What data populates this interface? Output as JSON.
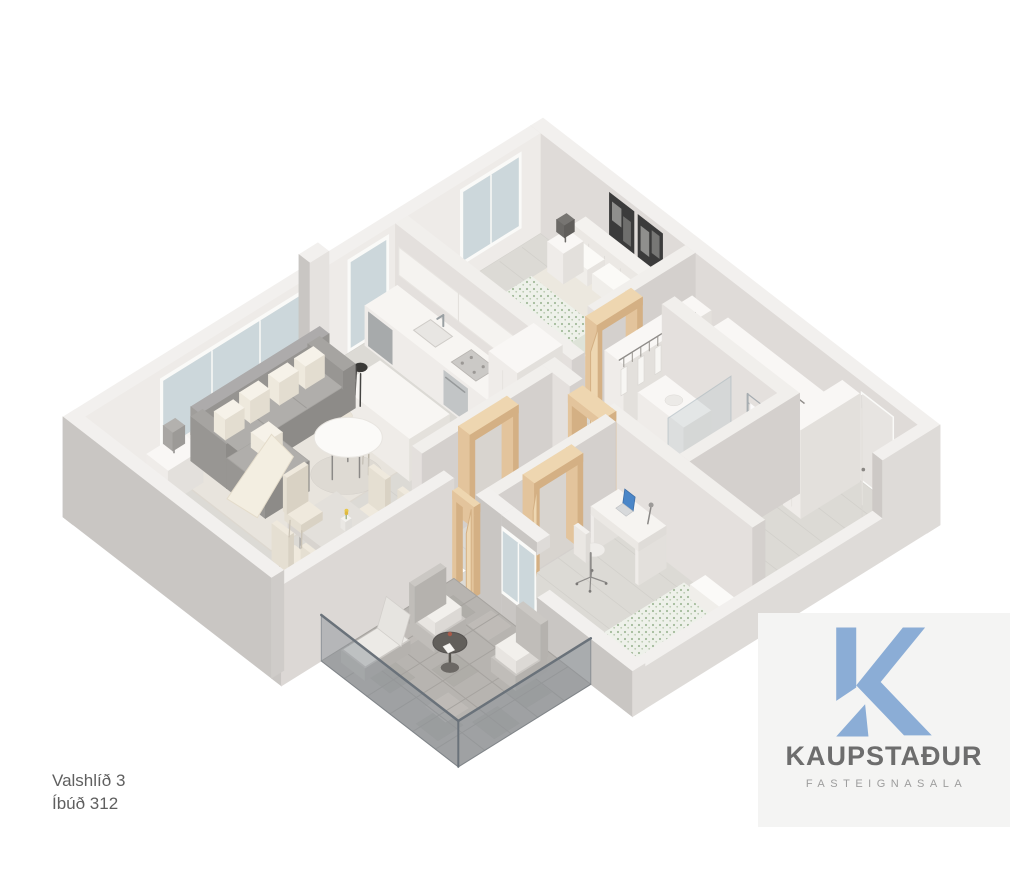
{
  "page": {
    "width": 1012,
    "height": 867,
    "background": "#ffffff"
  },
  "address": {
    "line1": "Valshlíð 3",
    "line2": "Íbúð 312"
  },
  "logo": {
    "brand": "KAUPSTAÐUR",
    "tagline": "FASTEIGNASALA",
    "k_color": "#8badd6",
    "brand_color": "#6d6d6d",
    "tagline_color": "#9d9d9d",
    "panel_bg": "#f4f4f3"
  },
  "floorplan": {
    "type": "3d-isometric-apartment-floor-plan",
    "rooms": [
      {
        "name": "living-room",
        "furniture": [
          "gray-sofa-with-chaise",
          "cream-throw-pillows",
          "throw-blanket",
          "round-white-coffee-table",
          "side-table-with-gray-lamp",
          "cream-rug",
          "large-window",
          "tall-window"
        ]
      },
      {
        "name": "dining-area",
        "furniture": [
          "rectangular-table",
          "six-cream-chairs",
          "vase-with-yellow-flowers"
        ]
      },
      {
        "name": "kitchen",
        "furniture": [
          "counter-with-sink-and-faucet",
          "dishwasher",
          "oven-with-cooktop",
          "upper-cabinets",
          "tall-cabinet",
          "white-island",
          "dark-bar-stools",
          "cream-bar-stools"
        ]
      },
      {
        "name": "master-bedroom",
        "furniture": [
          "double-bed-green-patterned-duvet",
          "upholstered-headboard",
          "two-nightstands-with-lamps",
          "two-black-and-white-artworks",
          "window",
          "open-wardrobe-with-hangers"
        ]
      },
      {
        "name": "bathroom",
        "furniture": [
          "vanity",
          "toilet",
          "shower-screen",
          "chrome-towel-radiator"
        ]
      },
      {
        "name": "hallway",
        "furniture": [
          "open-wardrobes-with-hangers",
          "white-entrance-door-ajar",
          "open-light-wood-door-frames"
        ]
      },
      {
        "name": "bedroom-2",
        "furniture": [
          "desk-with-blue-laptop",
          "desk-lamp",
          "white-office-chair",
          "bed-patterned-duvet",
          "window-to-balcony"
        ]
      },
      {
        "name": "balcony",
        "furniture": [
          "stone-tile-floor",
          "glass-railing",
          "round-dark-table",
          "outdoor-armchairs",
          "lounge-chair"
        ]
      }
    ],
    "palette": {
      "walls": "#f1efec",
      "wall_shadow": "#c9c6c3",
      "floor": "#dcdad5",
      "rug": "#e8e4dd",
      "window_glass": "#ccd7db",
      "balcony_glass": "#7e8891",
      "stone": "#b7b4b0",
      "wood_doors": "#e8cda6",
      "sofa": "#a3a19e",
      "duvet_green": "#a3bb9b",
      "laptop_blue": "#4a86c8"
    }
  }
}
